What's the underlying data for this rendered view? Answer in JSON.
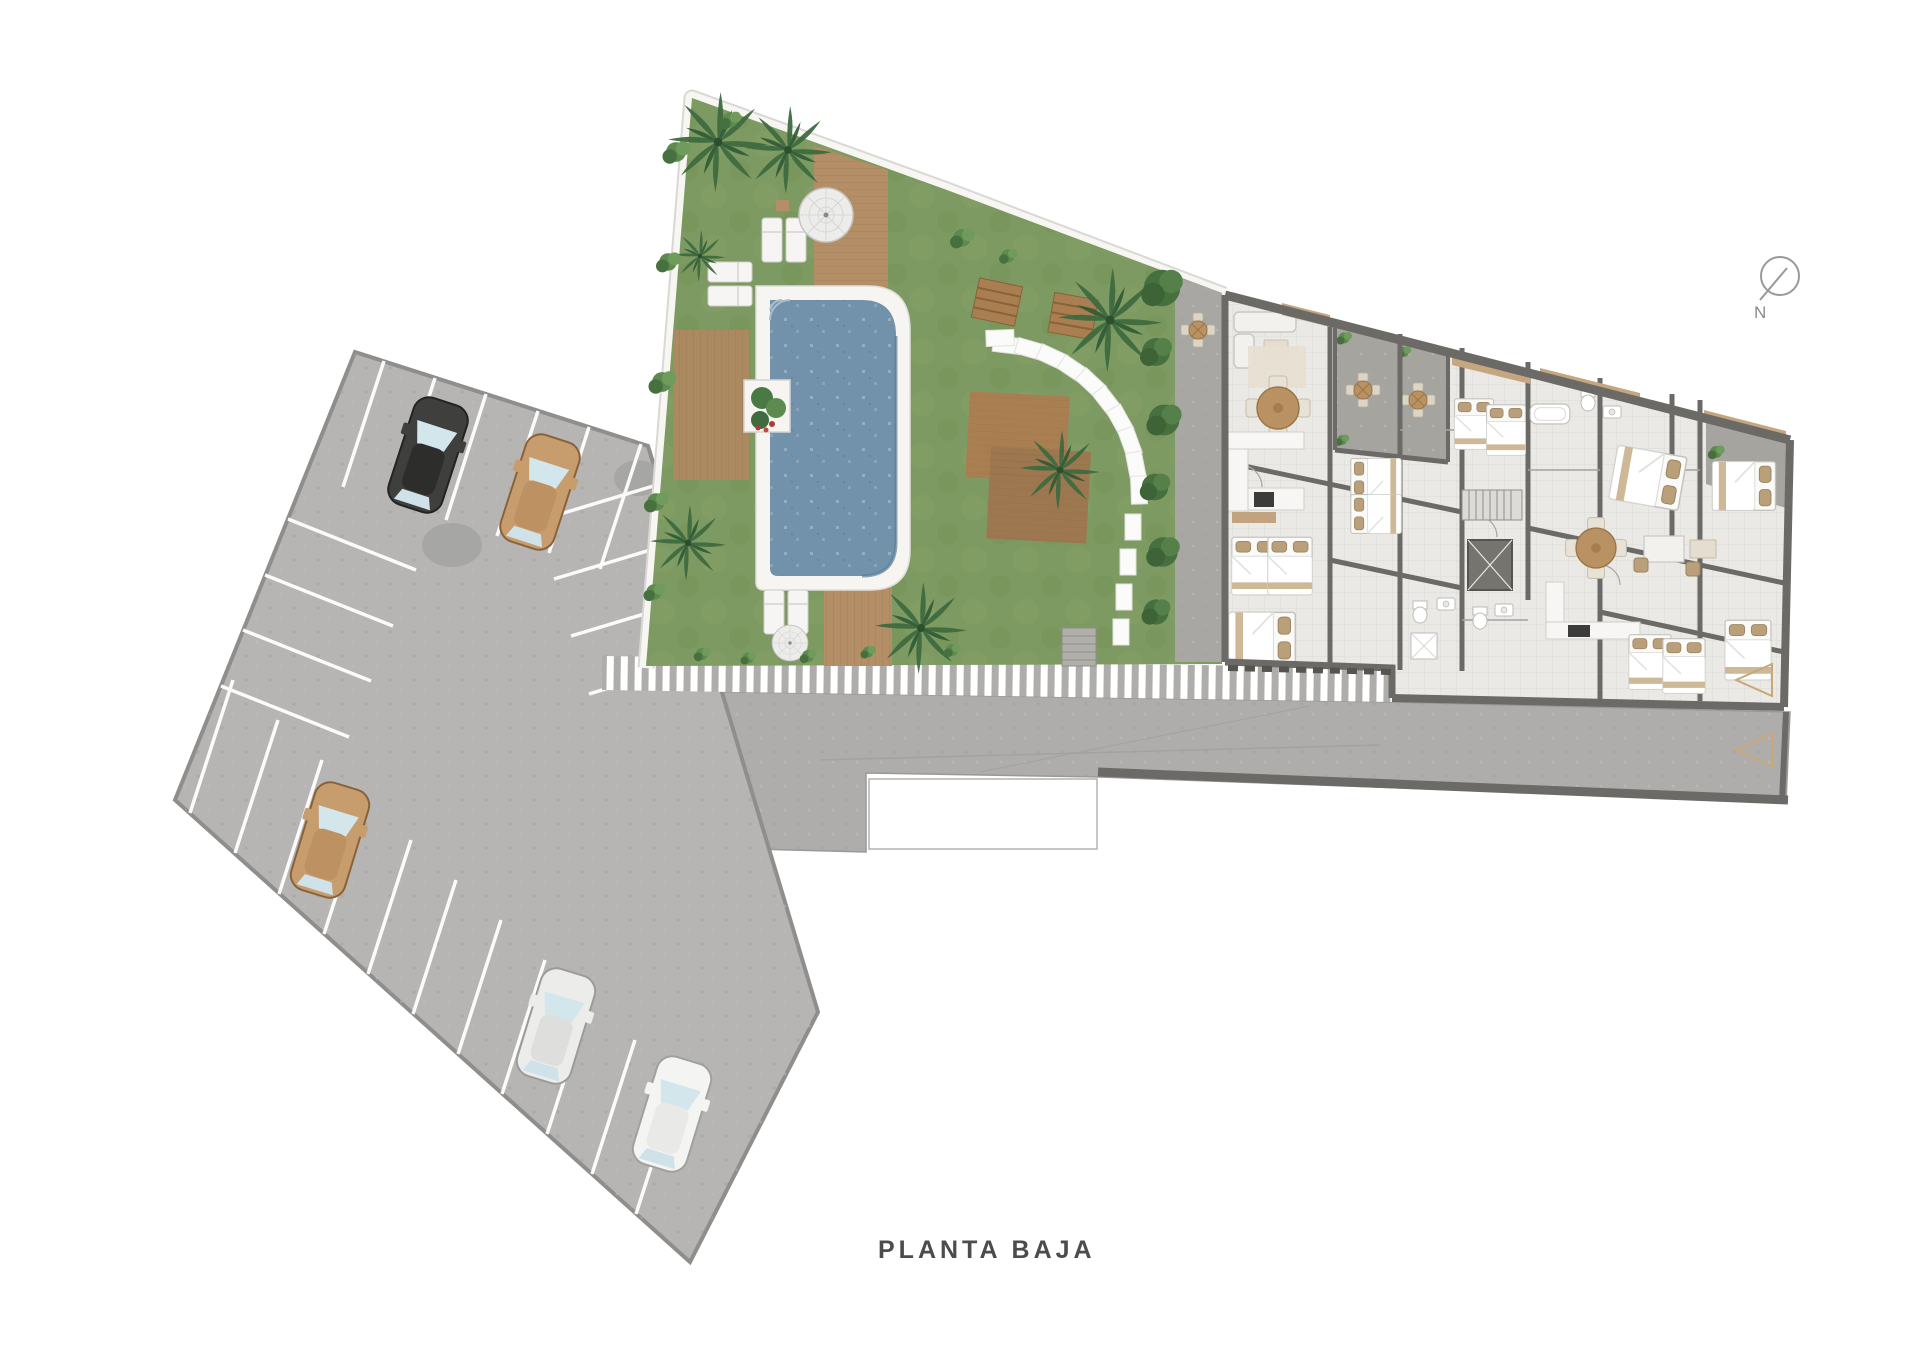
{
  "title": "PLANTA BAJA",
  "compass": {
    "label": "N"
  },
  "site": {
    "areas": [
      "parking-lot",
      "pool-garden",
      "gravel-courtyard",
      "apartment-building",
      "access-road"
    ],
    "counts": {
      "parked_cars": 5,
      "entrance_markers": 2,
      "swimming_pools": 1
    },
    "car_colors": [
      "black",
      "tan",
      "tan",
      "silver",
      "white"
    ]
  },
  "colors": {
    "background": "#ffffff",
    "pavement": "#b6b5b3",
    "road": "#aeadab",
    "lawn": "#7e9a63",
    "pool_water": "#7292ab",
    "pool_deck": "#f6f5f2",
    "wood": "#b48e66",
    "building_floor": "#eae9e6",
    "wall": "#6b6a67",
    "gravel": "#a8a7a3",
    "accent": "#c9a877",
    "text": "#4c4c4a"
  }
}
